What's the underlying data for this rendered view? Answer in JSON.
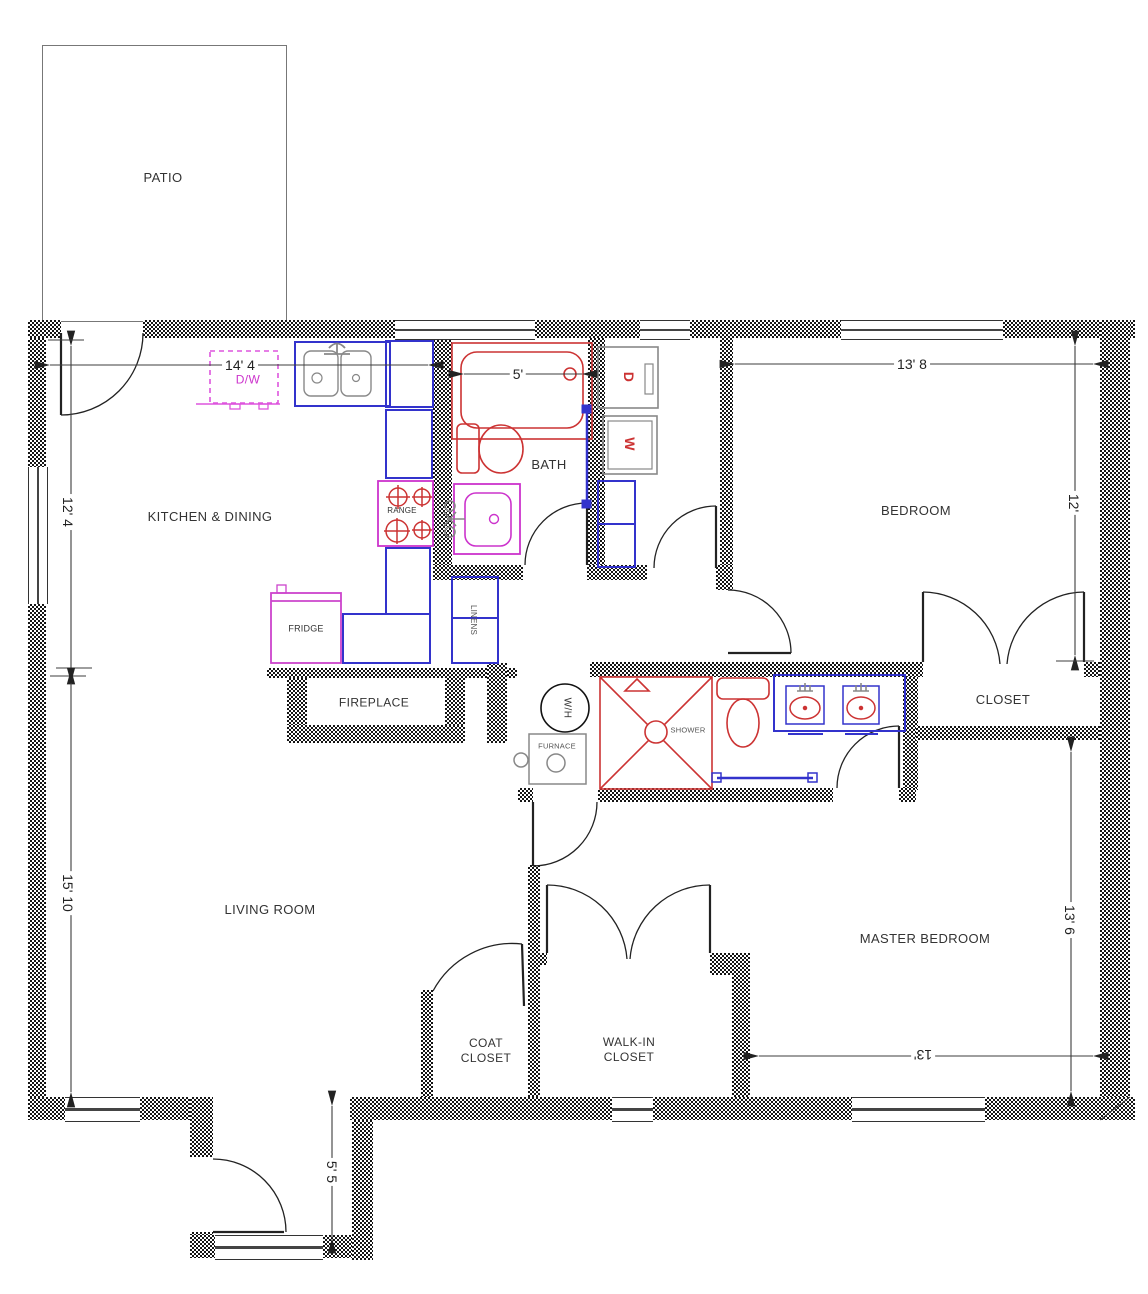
{
  "rooms": {
    "patio": "PATIO",
    "kitchen": "KITCHEN & DINING",
    "bath": "BATH",
    "bedroom": "BEDROOM",
    "closet": "CLOSET",
    "living_room": "LIVING ROOM",
    "master_bedroom": "MASTER BEDROOM",
    "coat_closet": "COAT\nCLOSET",
    "walk_in_closet": "WALK-IN\nCLOSET"
  },
  "fixtures": {
    "dishwasher": "D/W",
    "range": "RANGE",
    "fridge": "FRIDGE",
    "linens": "LINENS",
    "fireplace": "FIREPLACE",
    "water_heater": "W/H",
    "furnace": "FURNACE",
    "shower": "SHOWER",
    "dryer": "D",
    "washer": "W"
  },
  "dimensions": {
    "kitchen_width": "14' 4",
    "kitchen_depth": "12' 4",
    "tub_width": "5'",
    "bedroom_width": "13' 8",
    "bedroom_depth": "12'",
    "living_depth": "15' 10",
    "master_depth": "13' 6",
    "master_width": "13'",
    "entry_width": "5' 5"
  },
  "colors": {
    "wall_hatch": "#151515",
    "casework_blue": "#3333cc",
    "plumbing_magenta": "#cc33cc",
    "fixture_red": "#cc3333",
    "appliance_gray": "#808080",
    "text": "#333333"
  }
}
